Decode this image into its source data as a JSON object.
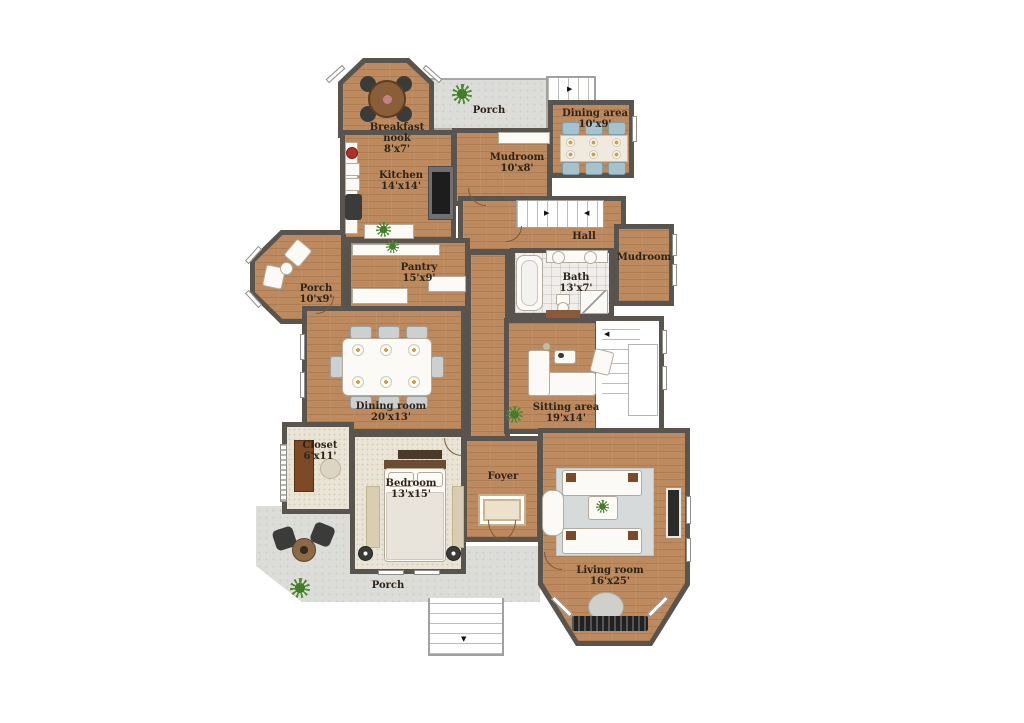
{
  "plan_type": "residential-floor-plan",
  "colors": {
    "wall": "#59544e",
    "wood_floor": "#bc8a5e",
    "porch_concrete": "#dcdcd8",
    "carpet": "#e9e4d6",
    "bath_tile": "#efeeeb",
    "label_text": "#2f2317",
    "chair_blue": "#a6c3cd",
    "living_rug": "#d6dadb",
    "appliance_red": "#b23028",
    "plant_green": "#4e8a33"
  },
  "rooms": [
    {
      "id": "breakfast-nook",
      "label": "Breakfast nook",
      "dims": "8'x7'"
    },
    {
      "id": "porch-top",
      "label": "Porch",
      "dims": ""
    },
    {
      "id": "dining-area",
      "label": "Dining area",
      "dims": "10'x9'"
    },
    {
      "id": "mudroom-top",
      "label": "Mudroom",
      "dims": "10'x8'"
    },
    {
      "id": "kitchen",
      "label": "Kitchen",
      "dims": "14'x14'"
    },
    {
      "id": "hall",
      "label": "Hall",
      "dims": ""
    },
    {
      "id": "mudroom-right",
      "label": "Mudroom",
      "dims": ""
    },
    {
      "id": "pantry",
      "label": "Pantry",
      "dims": "15'x9'"
    },
    {
      "id": "porch-left",
      "label": "Porch",
      "dims": "10'x9'"
    },
    {
      "id": "bath",
      "label": "Bath",
      "dims": "13'x7'"
    },
    {
      "id": "dining-room",
      "label": "Dining room",
      "dims": "20'x13'"
    },
    {
      "id": "sitting-area",
      "label": "Sitting area",
      "dims": "19'x14'"
    },
    {
      "id": "closet",
      "label": "Closet",
      "dims": "6'x11'"
    },
    {
      "id": "bedroom",
      "label": "Bedroom",
      "dims": "13'x15'"
    },
    {
      "id": "foyer",
      "label": "Foyer",
      "dims": ""
    },
    {
      "id": "living-room",
      "label": "Living room",
      "dims": "16'x25'"
    },
    {
      "id": "porch-bottom",
      "label": "Porch",
      "dims": ""
    }
  ]
}
